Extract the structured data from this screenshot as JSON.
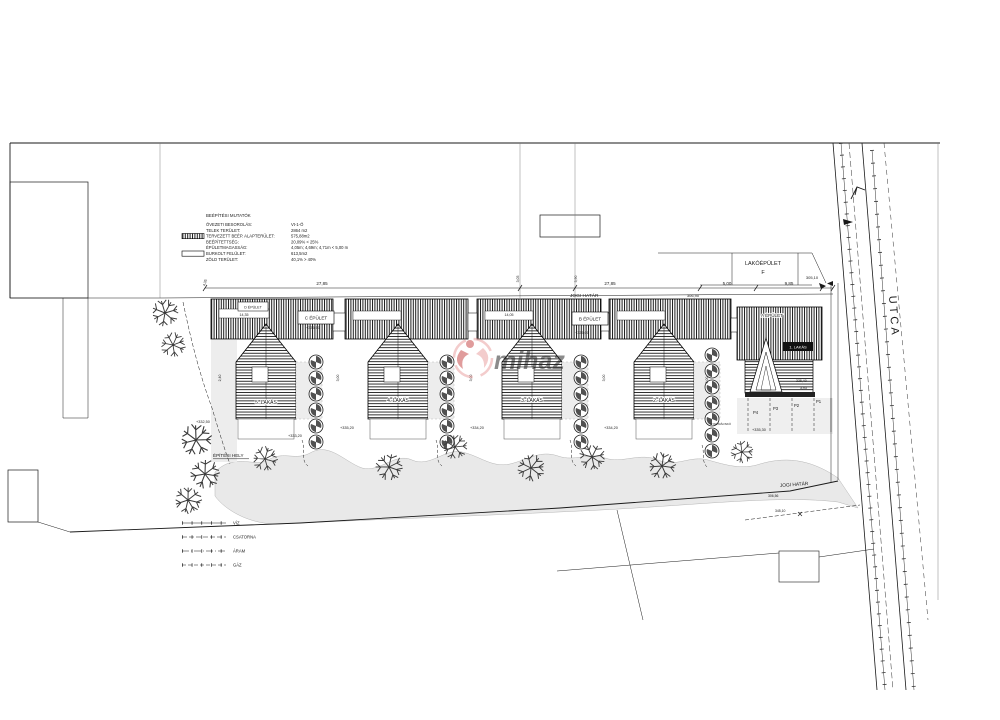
{
  "stats": {
    "title": "BEÉPÍTÉSI MUTATÓK",
    "rows": [
      {
        "label": "ÖVEZETI BESOROLÁS:",
        "value": "Vt-1-Ö"
      },
      {
        "label": "TELEK TERÜLET:",
        "value": "2864 m2"
      },
      {
        "label": "TERVEZETT BEÉP. ALAPTERÜLET:",
        "value": "575,88m2"
      },
      {
        "label": "BEÉPÍTETTSÉG:",
        "value": "20,09% < 25%"
      },
      {
        "label": "ÉPÜLETMAGASSÁG:",
        "value": "4,05m; 4,69m; 4,71m < 5,00 m"
      },
      {
        "label": "BURKOLT FELÜLET:",
        "value": "613,5m2"
      },
      {
        "label": "ZÖLD TERÜLET:",
        "value": "40,1% > 40%"
      }
    ]
  },
  "legend": {
    "items": [
      "VÍZ",
      "CSATORNA",
      "ÁRAM",
      "GÁZ"
    ]
  },
  "buildings": {
    "a": "A ÉPÜLET",
    "b": "B ÉPÜLET",
    "c": "C ÉPÜLET",
    "d": "D ÉPÜLET",
    "unit1": "1. LAKÁS"
  },
  "neighbor": {
    "line1": "LAKÓÉPÜLET",
    "line2": "F"
  },
  "street": {
    "label": "UTCA"
  },
  "site": {
    "building_area_label": "ÉPÍTÉSI HELY",
    "legal_boundary_label": "JOGI HATÁR"
  },
  "watermark": {
    "text": "mihaz",
    "color": "#e89a9a",
    "accent": "#c23b3b"
  },
  "annotations": [
    {
      "t": "27,85",
      "x": 322,
      "y": 285,
      "s": 4.5,
      "anchor": "middle"
    },
    {
      "t": "27,85",
      "x": 610,
      "y": 285,
      "s": 4.5,
      "anchor": "middle"
    },
    {
      "t": "5,00",
      "x": 727,
      "y": 285,
      "s": 4.5,
      "anchor": "middle"
    },
    {
      "t": "9,85",
      "x": 789,
      "y": 285,
      "s": 4.5,
      "anchor": "middle"
    },
    {
      "t": "305,10",
      "x": 812,
      "y": 279,
      "s": 4,
      "anchor": "middle"
    },
    {
      "t": "306,90",
      "x": 693,
      "y": 297,
      "s": 4,
      "anchor": "middle"
    },
    {
      "t": "4,35",
      "x": 206,
      "y": 283,
      "rot": -75,
      "s": 3.5,
      "anchor": "middle"
    },
    {
      "t": "3,05",
      "x": 519,
      "y": 279,
      "rot": -90,
      "s": 3.5,
      "anchor": "middle"
    },
    {
      "t": "5,90",
      "x": 577,
      "y": 279,
      "rot": -90,
      "s": 3.5,
      "anchor": "middle"
    },
    {
      "t": "14,35",
      "x": 244,
      "y": 316,
      "s": 3.6,
      "anchor": "middle"
    },
    {
      "t": "14,05",
      "x": 509,
      "y": 316,
      "s": 3.6,
      "anchor": "middle"
    },
    {
      "t": "2,40",
      "x": 221,
      "y": 378,
      "rot": -90,
      "s": 3.5,
      "anchor": "middle"
    },
    {
      "t": "3,00",
      "x": 339,
      "y": 378,
      "rot": -90,
      "s": 3.5,
      "anchor": "middle"
    },
    {
      "t": "3,00",
      "x": 472,
      "y": 378,
      "rot": -90,
      "s": 3.5,
      "anchor": "middle"
    },
    {
      "t": "3,00",
      "x": 605,
      "y": 378,
      "rot": -90,
      "s": 3.5,
      "anchor": "middle"
    },
    {
      "t": "6,00",
      "x": 708,
      "y": 380,
      "rot": -90,
      "s": 3.5,
      "anchor": "middle"
    },
    {
      "t": "5. LAKÁS",
      "x": 266,
      "y": 404,
      "s": 5,
      "anchor": "middle",
      "halo": true
    },
    {
      "t": "4. LAKÁS",
      "x": 398,
      "y": 402,
      "s": 5,
      "anchor": "middle",
      "halo": true
    },
    {
      "t": "3. LAKÁS",
      "x": 532,
      "y": 402,
      "s": 5,
      "anchor": "middle",
      "halo": true
    },
    {
      "t": "2. LAKÁS",
      "x": 664,
      "y": 402,
      "s": 5,
      "anchor": "middle",
      "halo": true
    },
    {
      "t": "+332,50",
      "x": 196,
      "y": 423,
      "s": 3.8
    },
    {
      "t": "+333,20",
      "x": 288,
      "y": 437,
      "s": 3.8
    },
    {
      "t": "+335,20",
      "x": 340,
      "y": 429,
      "s": 3.8
    },
    {
      "t": "+334,20",
      "x": 470,
      "y": 429,
      "s": 3.8
    },
    {
      "t": "+334,20",
      "x": 604,
      "y": 429,
      "s": 3.8
    },
    {
      "t": "+335,30",
      "x": 752,
      "y": 431,
      "s": 3.8
    },
    {
      "t": "+335,50",
      "x": 306,
      "y": 329,
      "s": 3.8
    },
    {
      "t": "+335,00",
      "x": 575,
      "y": 334,
      "s": 3.8
    },
    {
      "t": "335,40",
      "x": 796,
      "y": 382,
      "s": 3.5
    },
    {
      "t": "3,93",
      "x": 800,
      "y": 389,
      "s": 3.5
    },
    {
      "t": "P4",
      "x": 753,
      "y": 414,
      "s": 4.2
    },
    {
      "t": "P3",
      "x": 773,
      "y": 410,
      "s": 4.2
    },
    {
      "t": "P2",
      "x": 794,
      "y": 407,
      "s": 4.2
    },
    {
      "t": "P1",
      "x": 816,
      "y": 403,
      "s": 4.2
    },
    {
      "t": "GYEPRÁCSKŐ",
      "x": 710,
      "y": 425,
      "s": 3
    },
    {
      "t": "306,56",
      "x": 768,
      "y": 497,
      "s": 3.4
    },
    {
      "t": "345,10",
      "x": 775,
      "y": 512,
      "s": 3.4
    }
  ]
}
